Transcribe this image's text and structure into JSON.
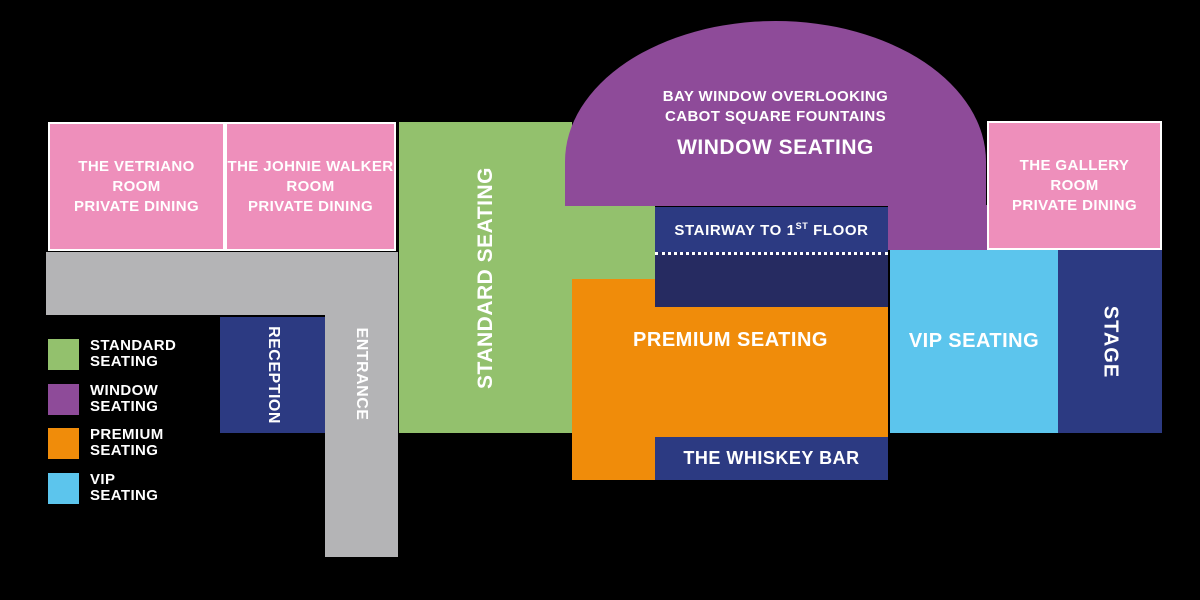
{
  "palette": {
    "background": "#000000",
    "pink": "#ee8fbb",
    "green": "#93c16d",
    "purple": "#8e4b99",
    "orange": "#f08c0a",
    "vip_blue": "#5cc5ed",
    "navy": "#2c3a82",
    "navy_dark": "#262b61",
    "gray": "#b4b4b6",
    "text": "#ffffff"
  },
  "rooms": {
    "vetriano": {
      "line1": "THE VETRIANO",
      "line2": "ROOM",
      "line3": "PRIVATE DINING"
    },
    "johnie_walker": {
      "line1": "THE JOHNIE WALKER",
      "line2": "ROOM",
      "line3": "PRIVATE DINING"
    },
    "gallery": {
      "line1": "THE GALLERY",
      "line2": "ROOM",
      "line3": "PRIVATE DINING"
    }
  },
  "window_seating": {
    "caption_line1": "BAY WINDOW OVERLOOKING",
    "caption_line2": "CABOT SQUARE FOUNTAINS",
    "label": "WINDOW SEATING"
  },
  "stairway": {
    "text_before_sup": "STAIRWAY TO 1",
    "sup": "ST",
    "text_after_sup": " FLOOR"
  },
  "labels": {
    "standard": "STANDARD SEATING",
    "premium": "PREMIUM SEATING",
    "vip": "VIP SEATING",
    "stage": "STAGE",
    "reception": "RECEPTION",
    "entrance": "ENTRANCE",
    "whiskey_bar": "THE WHISKEY BAR"
  },
  "legend": {
    "items": [
      {
        "id": "standard",
        "line1": "STANDARD",
        "line2": "SEATING",
        "color": "#93c16d"
      },
      {
        "id": "window",
        "line1": "WINDOW",
        "line2": "SEATING",
        "color": "#8e4b99"
      },
      {
        "id": "premium",
        "line1": "PREMIUM",
        "line2": "SEATING",
        "color": "#f08c0a"
      },
      {
        "id": "vip",
        "line1": "VIP",
        "line2": "SEATING",
        "color": "#5cc5ed"
      }
    ]
  }
}
